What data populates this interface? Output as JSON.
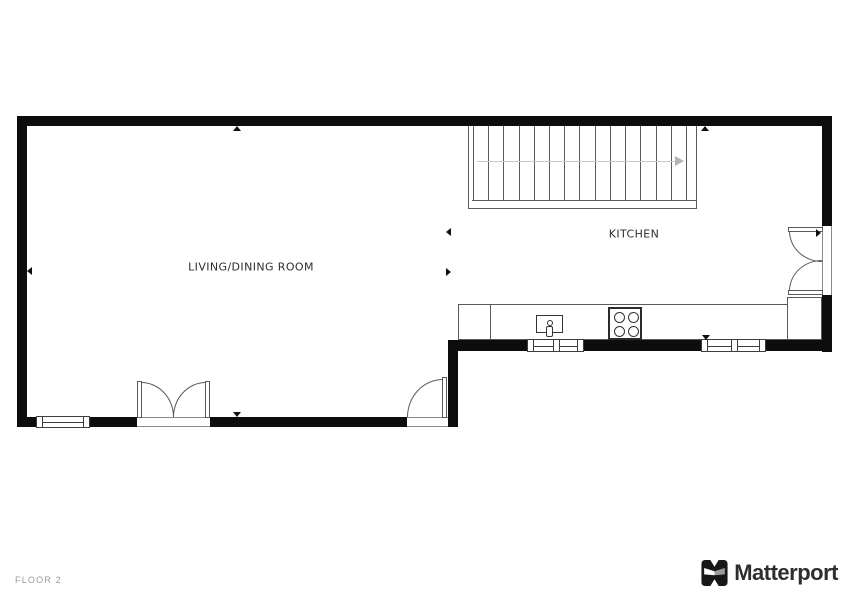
{
  "plan": {
    "floor_label": "FLOOR 2",
    "rooms": [
      {
        "name": "LIVING/DINING ROOM"
      },
      {
        "name": "KITCHEN"
      }
    ],
    "stairs": {
      "tread_count": 15,
      "direction": "right"
    },
    "fixtures": {
      "doors": [
        "double-door-south",
        "single-door-south",
        "double-door-east"
      ],
      "windows": [
        "window-southwest",
        "window-kitchen-sink",
        "window-kitchen-east"
      ],
      "appliances": [
        "kitchen-counter",
        "sink",
        "cooktop"
      ]
    },
    "wall_markers": [
      "up",
      "up",
      "left",
      "left",
      "right",
      "down",
      "down",
      "right"
    ]
  },
  "branding": {
    "name": "Matterport"
  },
  "colors": {
    "wall": "#0d0d0d",
    "line": "#5a5a5a",
    "line_dark": "#3d3d3d",
    "line_faint": "#c9c9c9",
    "label": "#2d2d2d",
    "footer": "#9b9b9b",
    "brand": "#2e2e2e"
  }
}
